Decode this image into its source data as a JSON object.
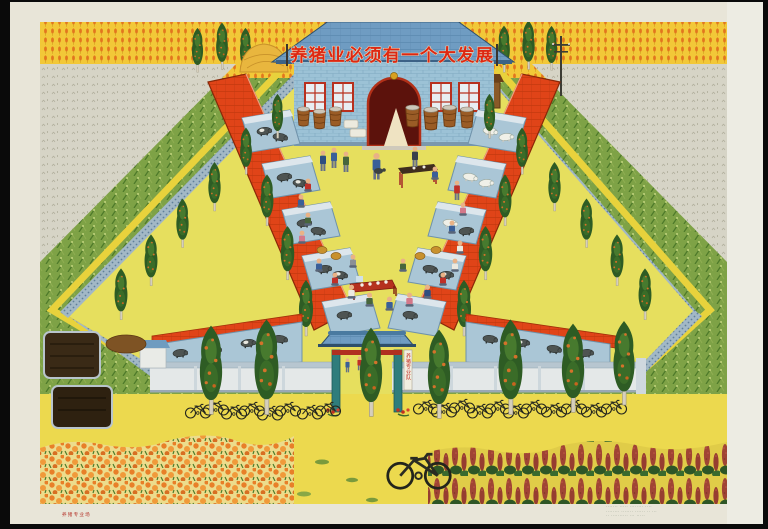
{
  "poster": {
    "banner_text": "养猪业必须有一个大发展",
    "gate_sign_text": "养猪专业队",
    "caption_left": "养猪专业场",
    "colophon": {
      "0": "·······  ·····  ········  ····",
      "1": "········  ·······  ······  ·· ···",
      "2": "·· ··········  ···  ·····"
    },
    "colors": {
      "background_black": "#0a0a0a",
      "margin_cream": "#e8e5d8",
      "field_gold": "#f2c838",
      "grain_orange": "#e2761e",
      "corn_green": "#7ea246",
      "stubble_gray": "#d6d4c6",
      "roof_red": "#e04418",
      "roof_blue": "#6f9cc2",
      "wall_speckle_blue": "#a2b8c6",
      "courtyard_yellow": "#e6df5e",
      "foreground_yellow": "#ecd94e",
      "banner_red": "#dd2812",
      "pig_dark": "#4e5452",
      "pig_white": "#f0f0e8",
      "flower_orange": "#e87f28",
      "celosia_red": "#a04434",
      "gate_teal": "#2f7d7c"
    }
  }
}
